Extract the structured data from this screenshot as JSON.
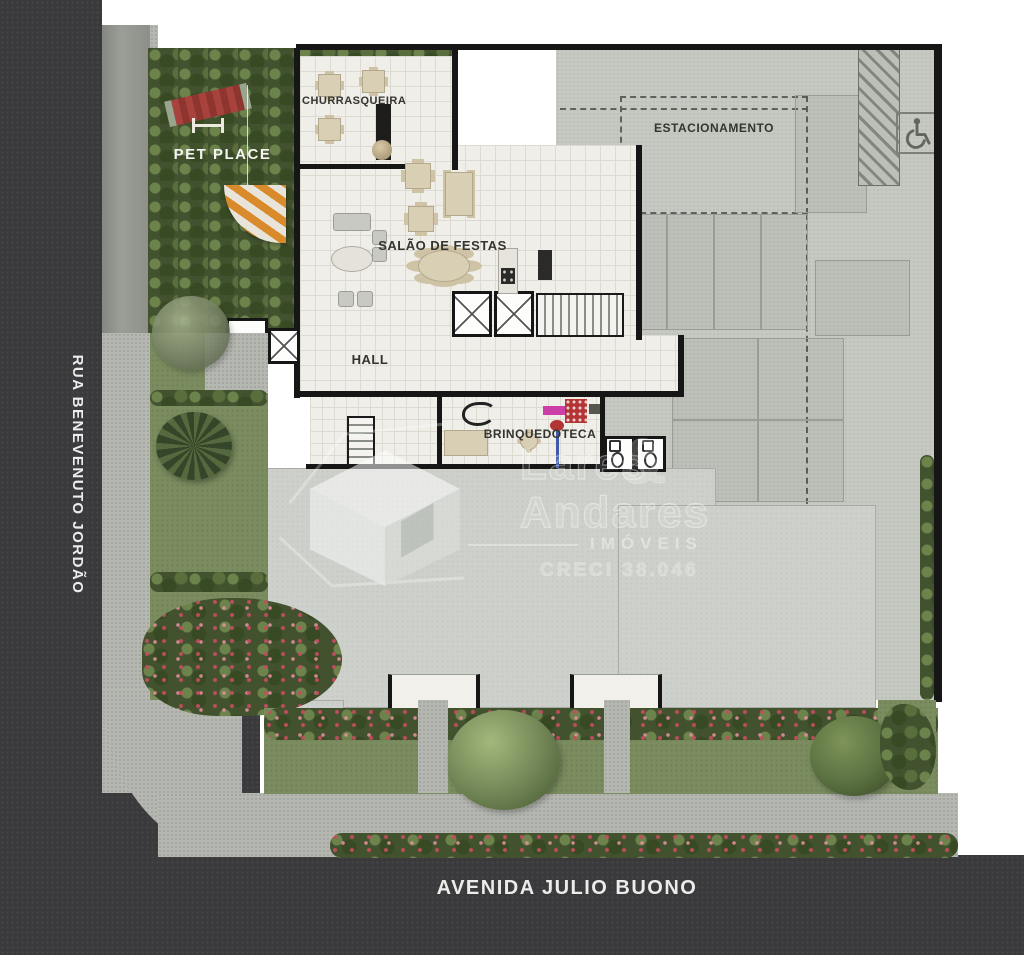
{
  "plan": {
    "streets": {
      "left": "RUA BENEVENUTO JORDÃO",
      "bottom": "AVENIDA JULIO BUONO"
    },
    "rooms": {
      "pet_place": "PET PLACE",
      "churrasqueira": "CHURRASQUEIRA",
      "salao_de_festas": "SALÃO DE FESTAS",
      "hall": "HALL",
      "estacionamento": "ESTACIONAMENTO",
      "brinquedoteca": "BRINQUEDOTECA"
    },
    "watermark": {
      "name_top": "Lares",
      "ampersand": "&",
      "name_bottom": "Andares",
      "tagline": "IMÓVEIS",
      "license": "CRECI 38.046"
    },
    "icons": {
      "accessible_parking": "wheelchair-icon"
    },
    "colors": {
      "street": "#3a3a3c",
      "sidewalk": "#b5b7b1",
      "grass": "#7b8c5f",
      "foliage": "#42522f",
      "tile": "#efeee8",
      "parking": "#c6c8c2",
      "building_slab": "#ced1cb",
      "wall": "#161616",
      "bench_red": "#a8423c",
      "toy_magenta": "#cc3fa8",
      "watermark": "#ffffff"
    }
  }
}
